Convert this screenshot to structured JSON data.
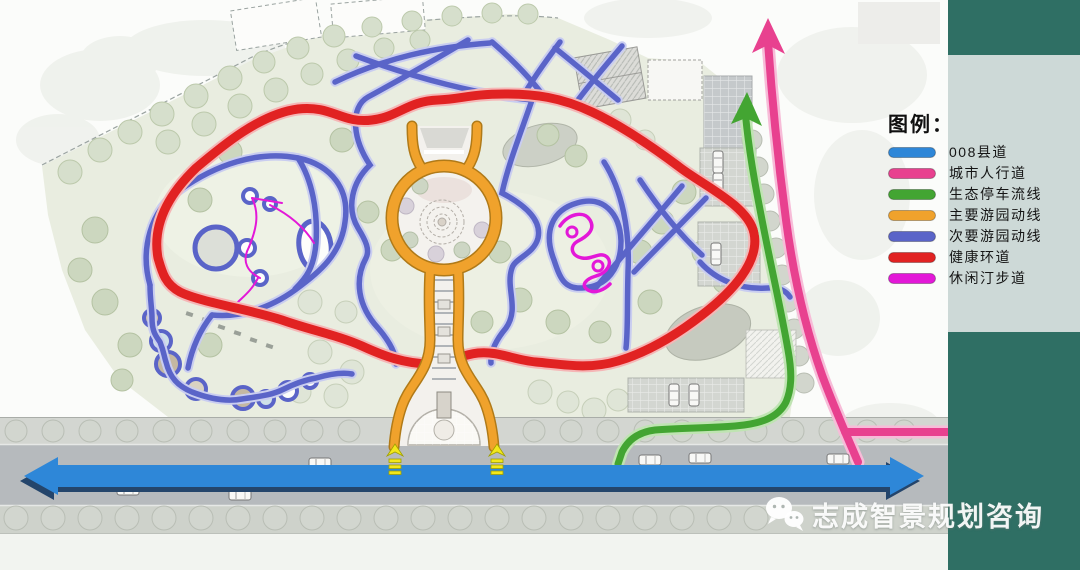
{
  "legend": {
    "title": "图例：",
    "items": [
      {
        "label": "008县道"
      },
      {
        "label": "城市人行道"
      },
      {
        "label": "生态停车流线"
      },
      {
        "label": "主要游园动线"
      },
      {
        "label": "次要游园动线"
      },
      {
        "label": "健康环道"
      },
      {
        "label": "休闲汀步道"
      }
    ]
  },
  "watermark": {
    "text": "志成智景规划咨询",
    "icon": "wechat-icon"
  },
  "icons": {
    "wechat": "two chat bubbles with dot eyes (WeChat logo)"
  },
  "colors": {
    "county_road": "#2e87d8",
    "county_road_shadow": "#24456b",
    "city_walkway": "#e8418f",
    "city_walkway_casing": "#f7bcd8",
    "eco_parking": "#43a532",
    "eco_parking_casing": "#bfe4b2",
    "main_tour": "#f0a22c",
    "main_tour_outline": "#b07a18",
    "secondary_tour": "#5a64c8",
    "secondary_tour_casing": "#c9cdf0",
    "health_loop": "#e12222",
    "health_loop_casing": "#f5b6b6",
    "stepping_path": "#e318d8",
    "entry_arrow": "#f2e71c",
    "sidebar_teal": "#2f6f64",
    "legend_panel": "#cdd9d7"
  }
}
